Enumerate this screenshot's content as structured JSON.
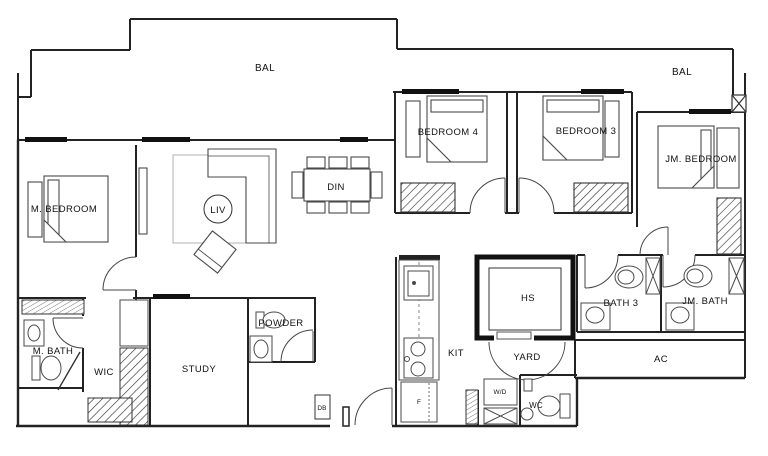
{
  "labels": {
    "bal_left": "BAL",
    "bal_right": "BAL",
    "bedroom4": "BEDROOM 4",
    "bedroom3": "BEDROOM 3",
    "jm_bedroom": "JM. BEDROOM",
    "m_bedroom": "M. BEDROOM",
    "liv": "LIV",
    "din": "DIN",
    "m_bath": "M. BATH",
    "wic": "WIC",
    "study": "STUDY",
    "powder": "POWDER",
    "db": "DB",
    "kit": "KIT",
    "hs": "HS",
    "yard": "YARD",
    "bath3": "BATH 3",
    "jm_bath": "JM. BATH",
    "ac": "AC",
    "wd": "W/D",
    "wc": "WC",
    "fridge": "F"
  },
  "colors": {
    "background": "#ffffff",
    "wall": "#222222",
    "furniture": "#4a4a4a",
    "door": "#444444",
    "label": "#111111",
    "rug": "#b0b0b0"
  }
}
